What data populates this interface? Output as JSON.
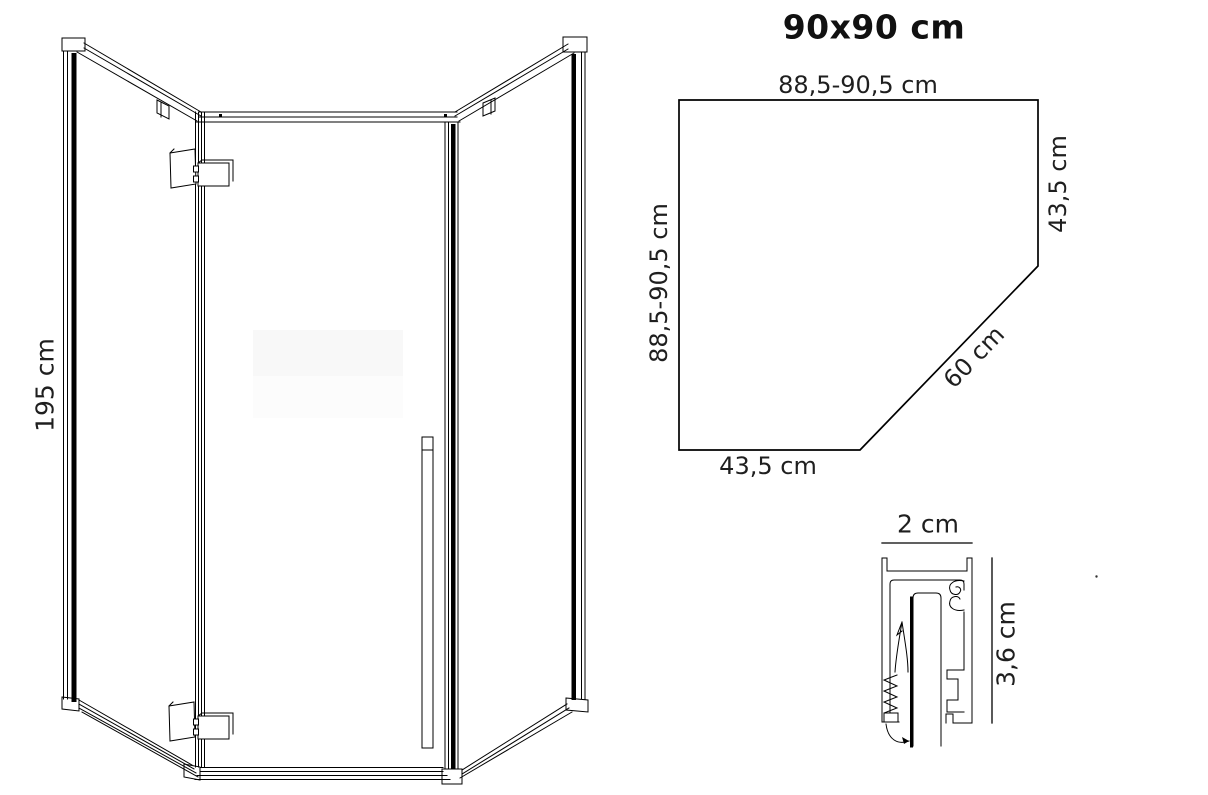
{
  "title": "90x90 cm",
  "front_view": {
    "height_label": "195 cm"
  },
  "top_view": {
    "top_width_label": "88,5-90,5 cm",
    "left_depth_label": "88,5-90,5 cm",
    "right_side_label": "43,5 cm",
    "diagonal_label": "60 cm",
    "bottom_width_label": "43,5 cm"
  },
  "profile_detail": {
    "width_label": "2 cm",
    "height_label": "3,6 cm"
  },
  "colors": {
    "line": "#000000",
    "text": "#1f1f1f",
    "background": "#ffffff"
  }
}
